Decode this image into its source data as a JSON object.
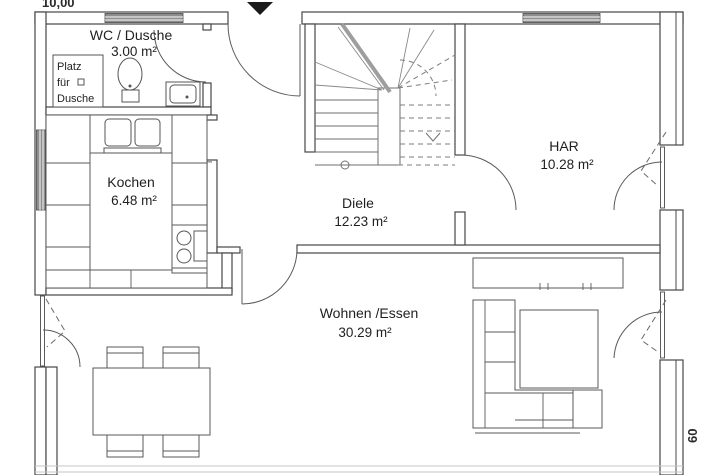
{
  "dimensions": {
    "top": "10,00",
    "right": "60"
  },
  "rooms": {
    "wc": {
      "name": "WC / Dusche",
      "area": "3.00 m²"
    },
    "kochen": {
      "name": "Kochen",
      "area": "6.48 m²"
    },
    "diele": {
      "name": "Diele",
      "area": "12.23 m²"
    },
    "har": {
      "name": "HAR",
      "area": "10.28 m²"
    },
    "wohnen": {
      "name": "Wohnen /Essen",
      "area": "30.29 m²"
    }
  },
  "annotations": {
    "shower_line1": "Platz",
    "shower_line2": "für",
    "shower_line3": "Dusche"
  },
  "colors": {
    "wall_line": "#474747",
    "window_fill": "#8e8e8e",
    "cut_line": "#9e9e9e",
    "entrance_marker": "#1a1a1a",
    "background": "#ffffff"
  }
}
